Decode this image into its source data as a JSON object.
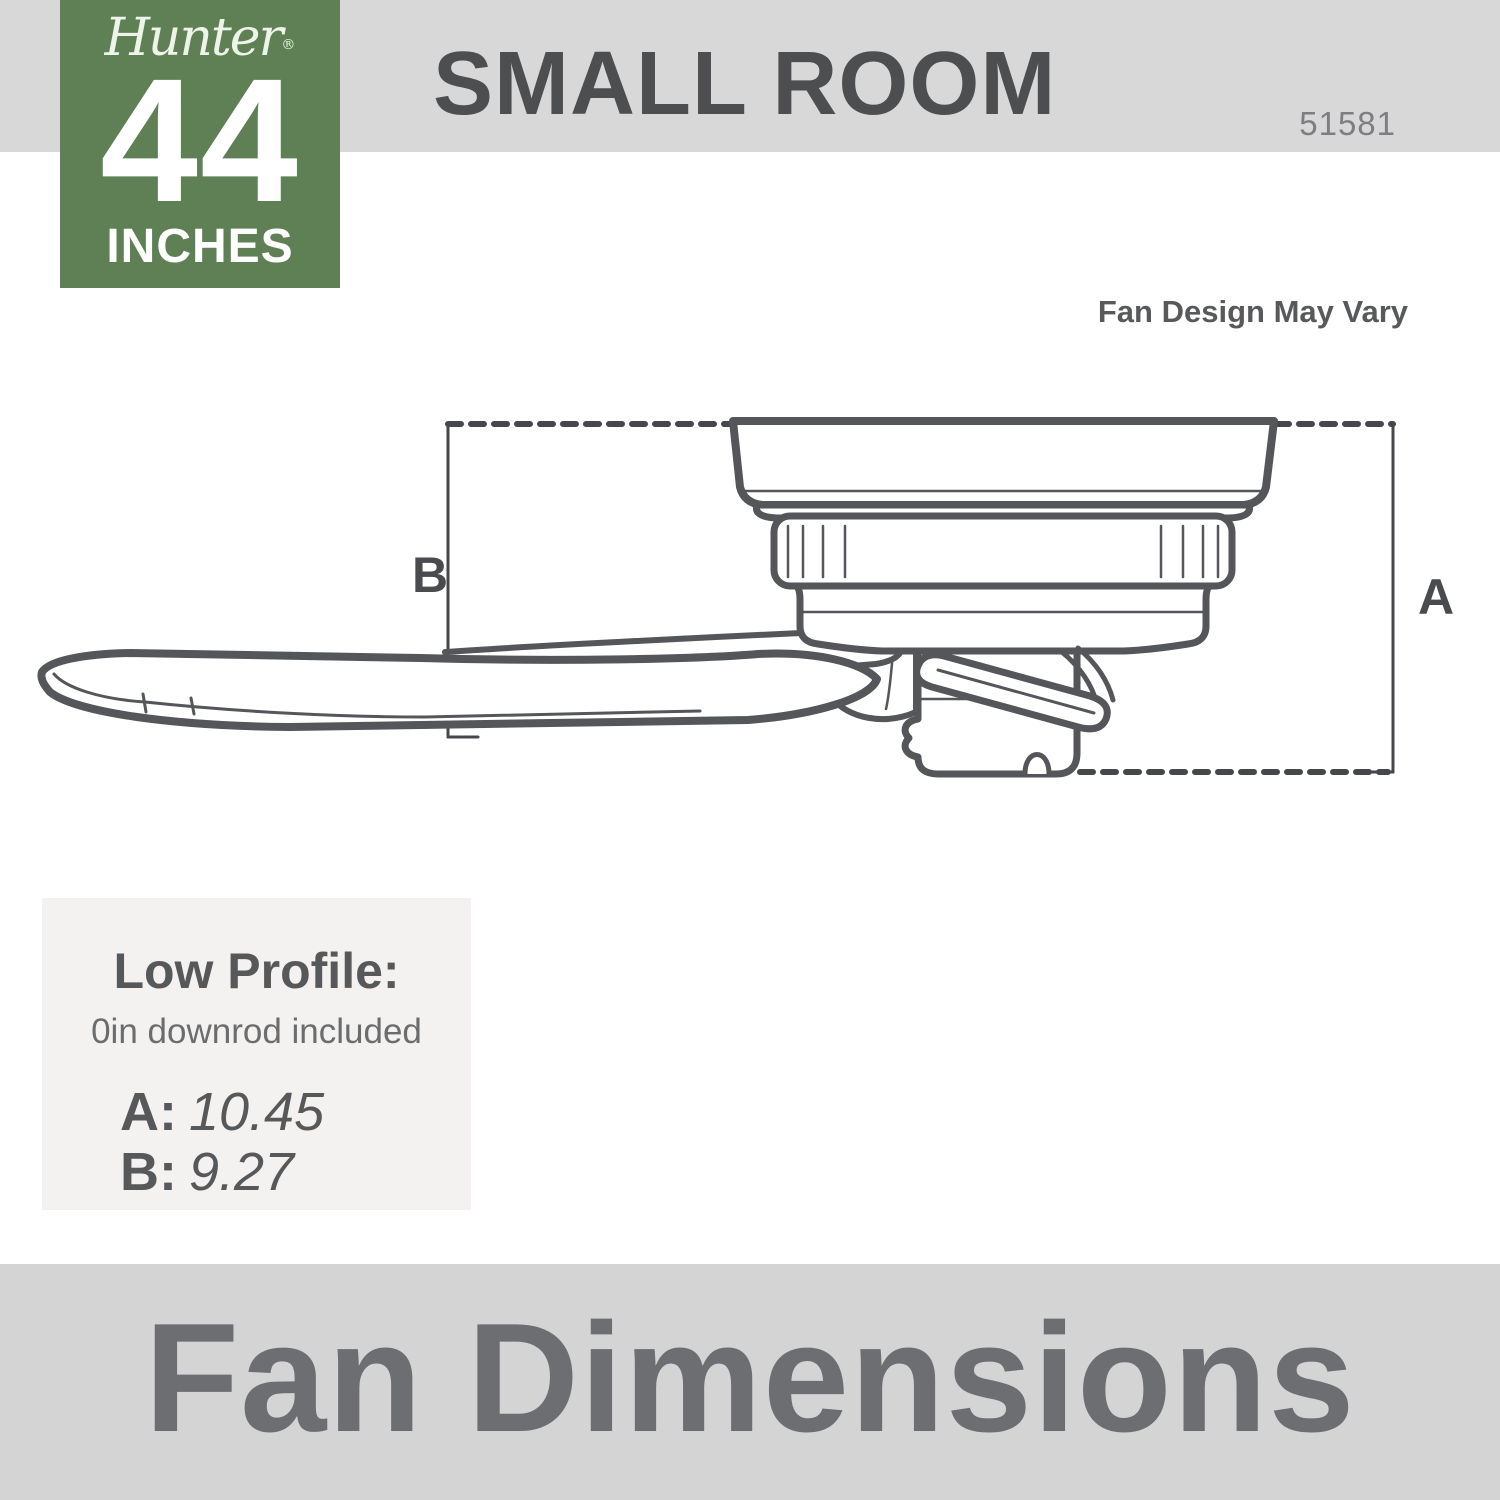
{
  "header": {
    "title": "SMALL ROOM",
    "model": "51581"
  },
  "badge": {
    "brand": "Hunter",
    "registered": "®",
    "size_number": "44",
    "size_unit": "INCHES"
  },
  "note": "Fan Design May Vary",
  "diagram": {
    "label_a": "A",
    "label_b": "B"
  },
  "specs": {
    "heading": "Low Profile:",
    "subheading": "0in downrod included",
    "rows": [
      {
        "label": "A:",
        "value": "10.45"
      },
      {
        "label": "B:",
        "value": "9.27"
      }
    ]
  },
  "footer": {
    "title": "Fan Dimensions"
  },
  "colors": {
    "badge_green": "#5e8054",
    "top_bar_gray": "#d8d8d8",
    "footer_bar_gray": "#d4d4d5",
    "spec_box_gray": "#f3f2f1",
    "line_art": "#54565a",
    "title_text": "#4d4e50",
    "footer_text": "#6d6e71"
  }
}
